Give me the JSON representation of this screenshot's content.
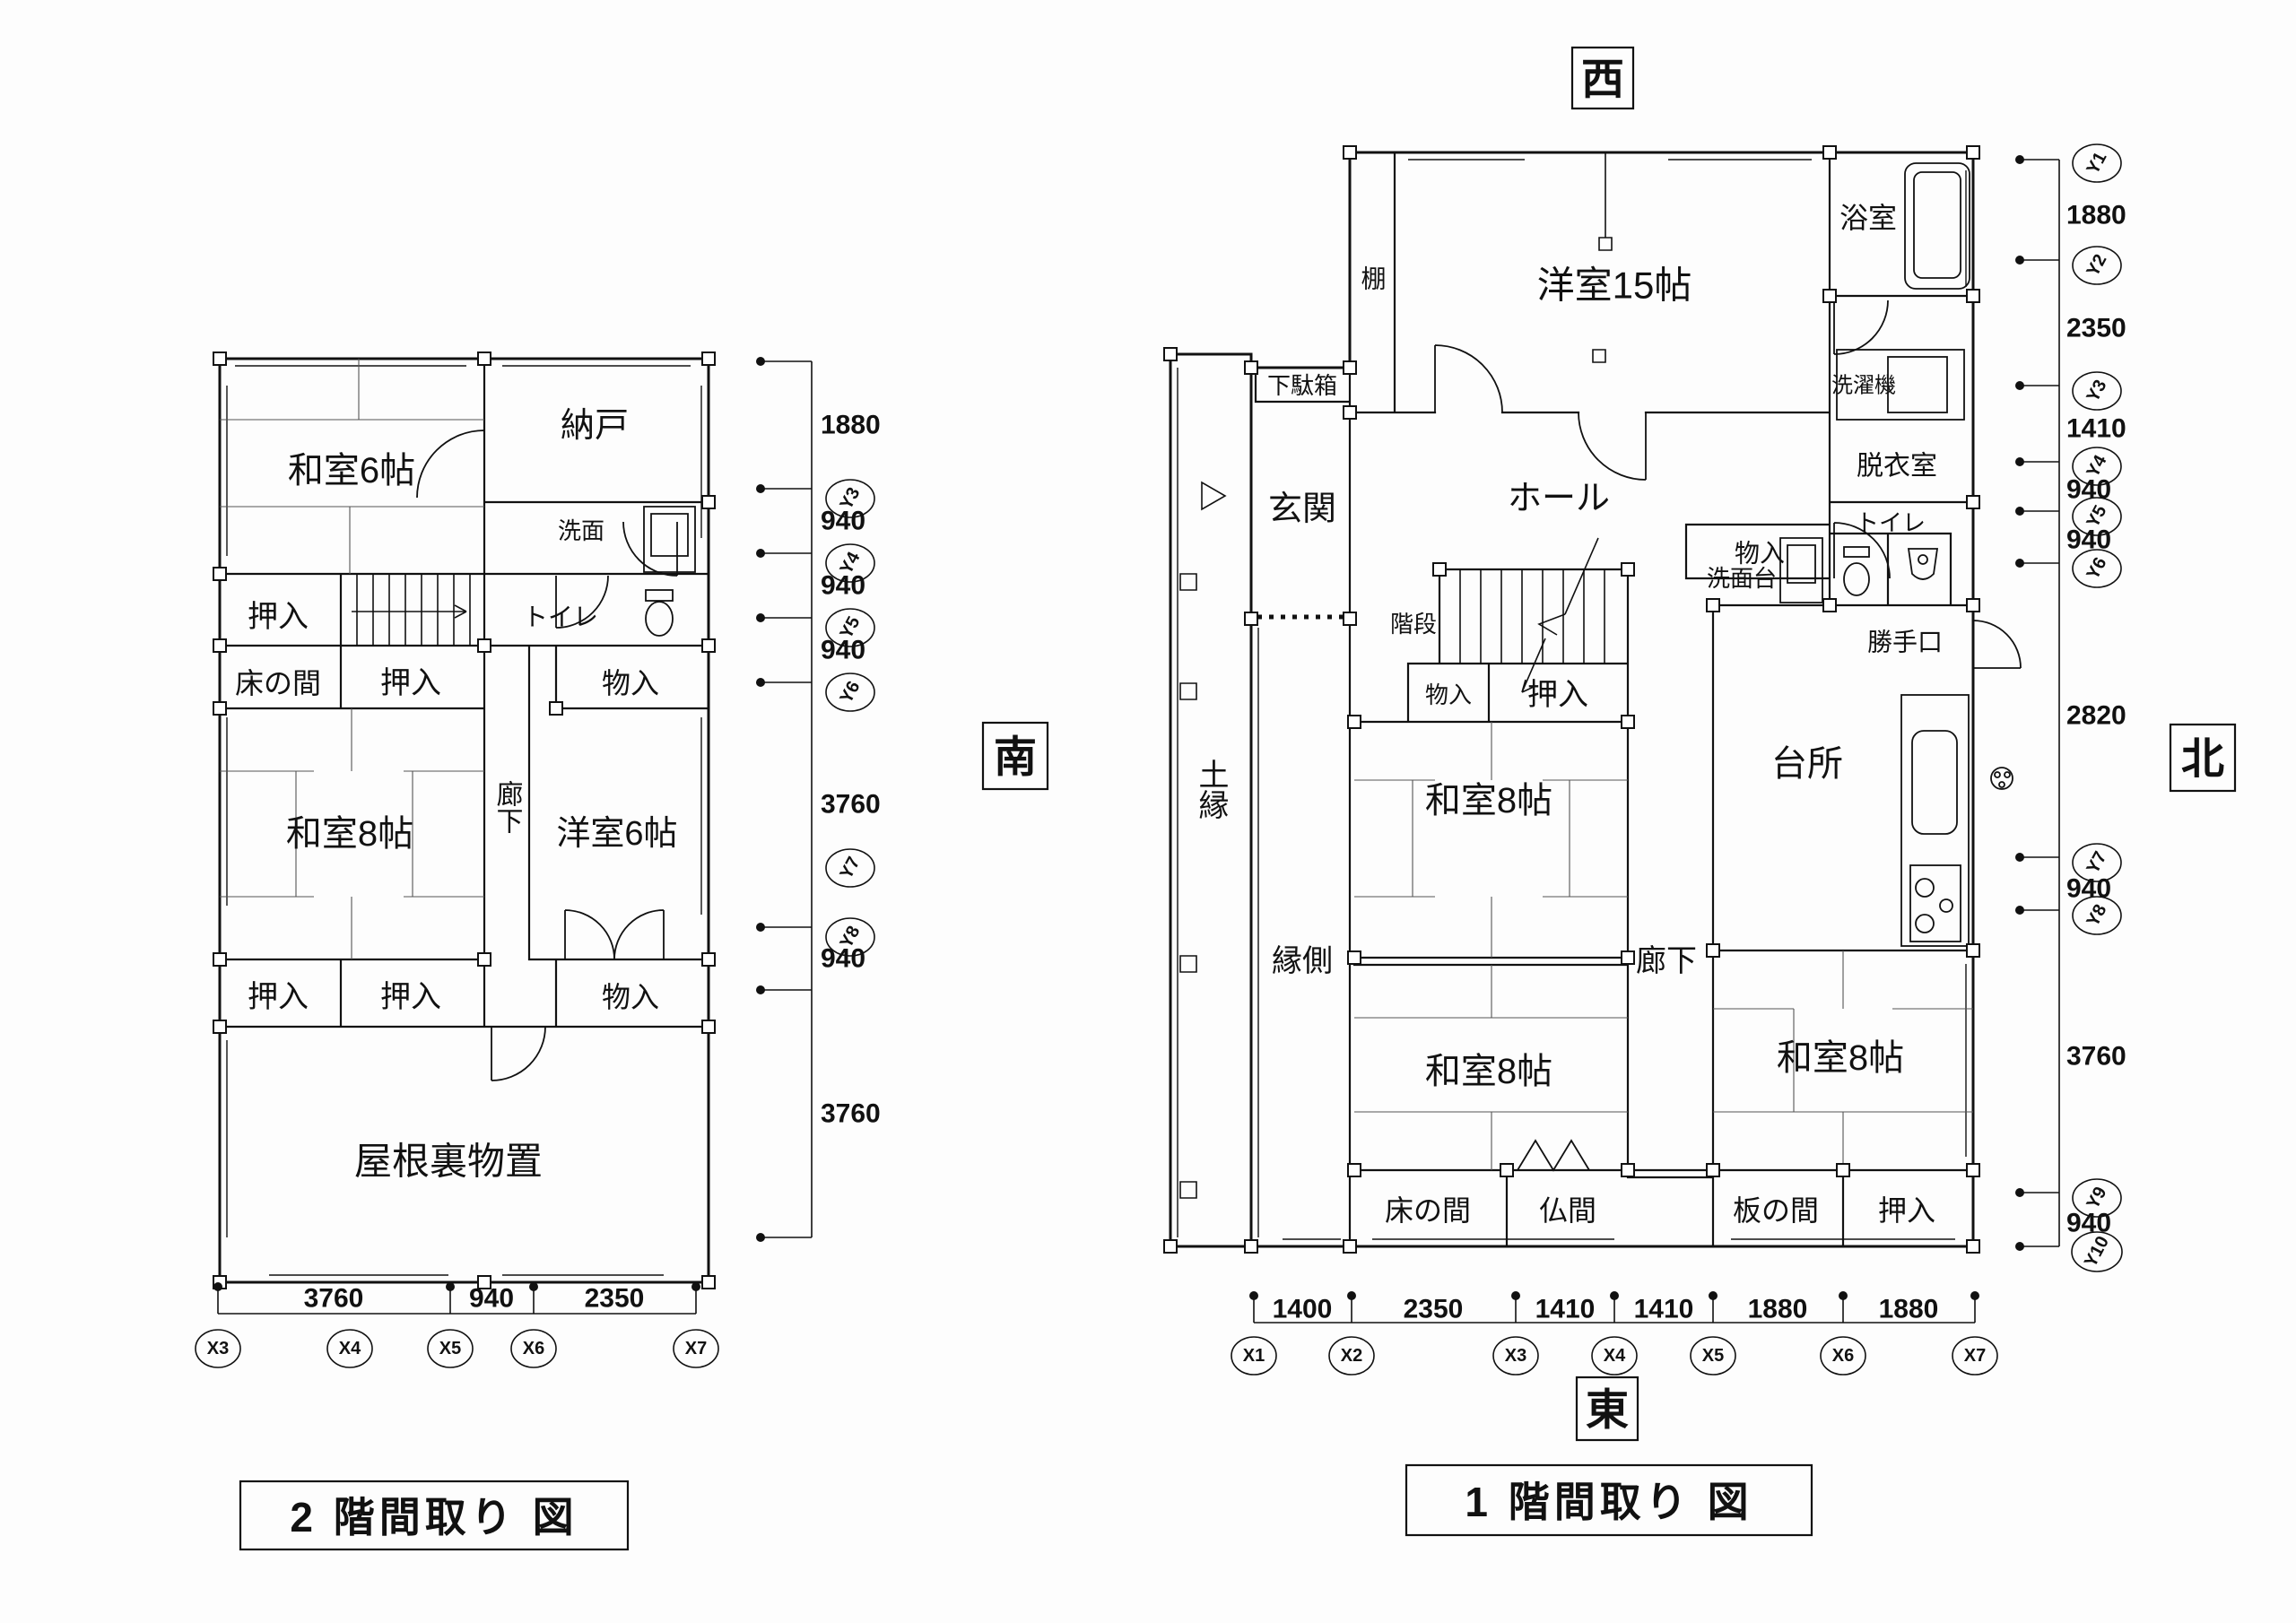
{
  "titles": {
    "floor2": "2 階間取り 図",
    "floor1": "1 階間取り 図"
  },
  "directions": {
    "west": "西",
    "south": "南",
    "north": "北",
    "east": "東"
  },
  "plan2f": {
    "rooms": [
      "和室6帖",
      "納戸",
      "洗面",
      "トイレ",
      "押入",
      "床の間",
      "押入",
      "物入",
      "和室8帖",
      "廊下",
      "洋室6帖",
      "押入",
      "押入",
      "物入",
      "屋根裏物置"
    ],
    "dims_right": [
      "1880",
      "940",
      "940",
      "940",
      "3760",
      "940",
      "3760"
    ],
    "dims_bottom": [
      "3760",
      "940",
      "2350"
    ],
    "grid_y": [
      "Y3",
      "Y4",
      "Y5",
      "Y6",
      "Y7",
      "Y8"
    ],
    "grid_x": [
      "X3",
      "X4",
      "X5",
      "X6",
      "X7"
    ]
  },
  "plan1f": {
    "rooms": [
      "棚",
      "洋室15帖",
      "浴室",
      "洗濯機",
      "脱衣室",
      "物入",
      "下駄箱",
      "玄関",
      "ホール",
      "階段",
      "物入",
      "押入",
      "トイレ",
      "洗面台",
      "勝手口",
      "台所",
      "土縁",
      "縁側",
      "廊下",
      "和室8帖",
      "和室8帖",
      "和室8帖",
      "床の間",
      "仏間",
      "板の間",
      "押入"
    ],
    "dims_right": [
      "1880",
      "2350",
      "1410",
      "940",
      "940",
      "2820",
      "940",
      "3760",
      "940"
    ],
    "dims_bottom": [
      "1400",
      "2350",
      "1410",
      "1410",
      "1880",
      "1880"
    ],
    "grid_y": [
      "Y1",
      "Y2",
      "Y3",
      "Y4",
      "Y5",
      "Y6",
      "Y7",
      "Y8",
      "Y9",
      "Y10"
    ],
    "grid_x": [
      "X1",
      "X2",
      "X3",
      "X4",
      "X5",
      "X6",
      "X7"
    ]
  }
}
